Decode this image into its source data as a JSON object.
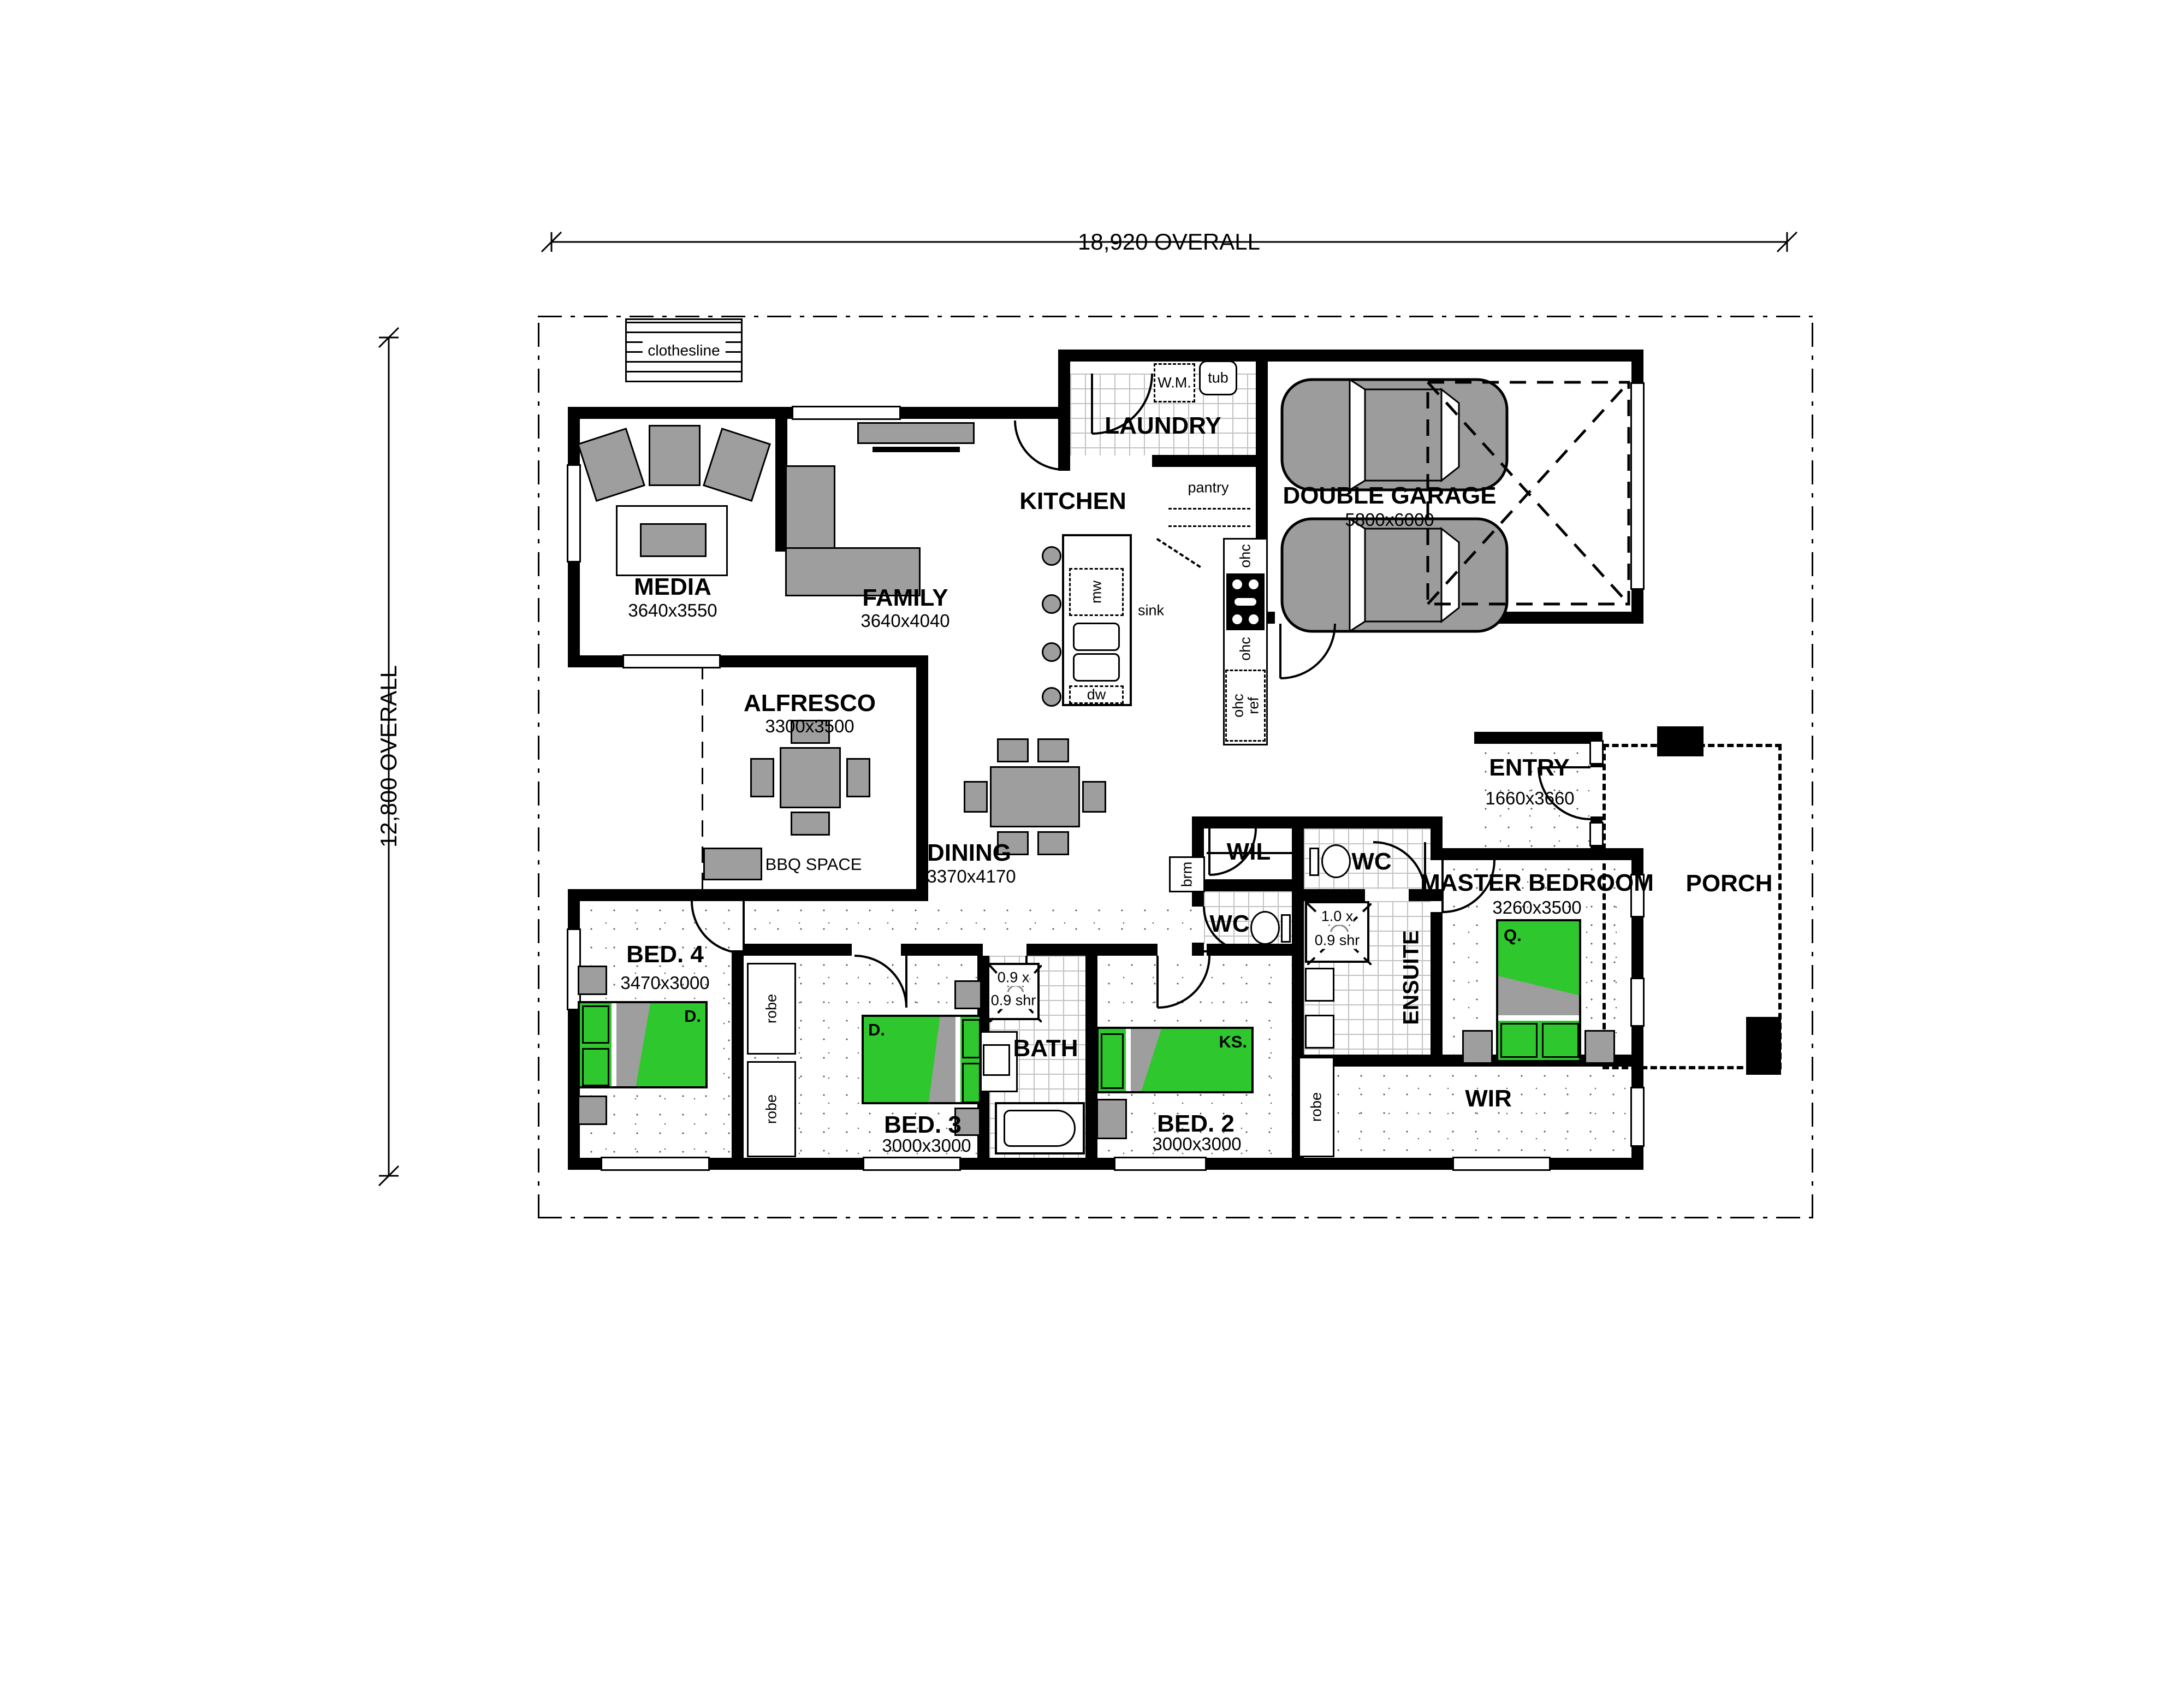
{
  "dimensions": {
    "overall_width": "18,920 OVERALL",
    "overall_height": "12,800 OVERALL"
  },
  "rooms": {
    "media": {
      "name": "MEDIA",
      "size": "3640x3550"
    },
    "family": {
      "name": "FAMILY",
      "size": "3640x4040"
    },
    "laundry": {
      "name": "LAUNDRY"
    },
    "kitchen": {
      "name": "KITCHEN"
    },
    "pantry": {
      "name": "pantry"
    },
    "garage": {
      "name": "DOUBLE GARAGE",
      "size": "5800x6000"
    },
    "alfresco": {
      "name": "ALFRESCO",
      "size": "3300x3500"
    },
    "bbq": {
      "name": "BBQ SPACE"
    },
    "dining": {
      "name": "DINING",
      "size": "3370x4170"
    },
    "wil": {
      "name": "WIL"
    },
    "wc": {
      "name": "WC"
    },
    "entry": {
      "name": "ENTRY",
      "size": "1660x3660"
    },
    "master": {
      "name": "MASTER BEDROOM",
      "size": "3260x3500"
    },
    "porch": {
      "name": "PORCH"
    },
    "ensuite": {
      "name": "ENSUITE"
    },
    "wir": {
      "name": "WIR"
    },
    "bath": {
      "name": "BATH"
    },
    "bed2": {
      "name": "BED. 2",
      "size": "3000x3000"
    },
    "bed3": {
      "name": "BED. 3",
      "size": "3000x3000"
    },
    "bed4": {
      "name": "BED. 4",
      "size": "3470x3000"
    }
  },
  "fixtures": {
    "clothesline": "clothesline",
    "wm": "W.M.",
    "tub": "tub",
    "sink": "sink",
    "mw": "mw",
    "dw": "dw",
    "ohc": "ohc",
    "ref": "ref",
    "brm": "brm",
    "robe": "robe",
    "shower_large_l1": "1.0 x",
    "shower_large_l2": "0.9 shr",
    "shower_small_l1": "0.9 x",
    "shower_small_l2": "0.9 shr"
  },
  "beds": {
    "master": "Q.",
    "bed2": "KS.",
    "bed3": "D.",
    "bed4": "D."
  },
  "colors": {
    "bed_green": "#2ec82e",
    "furniture_gray": "#9e9e9e",
    "wall_black": "#000000"
  }
}
